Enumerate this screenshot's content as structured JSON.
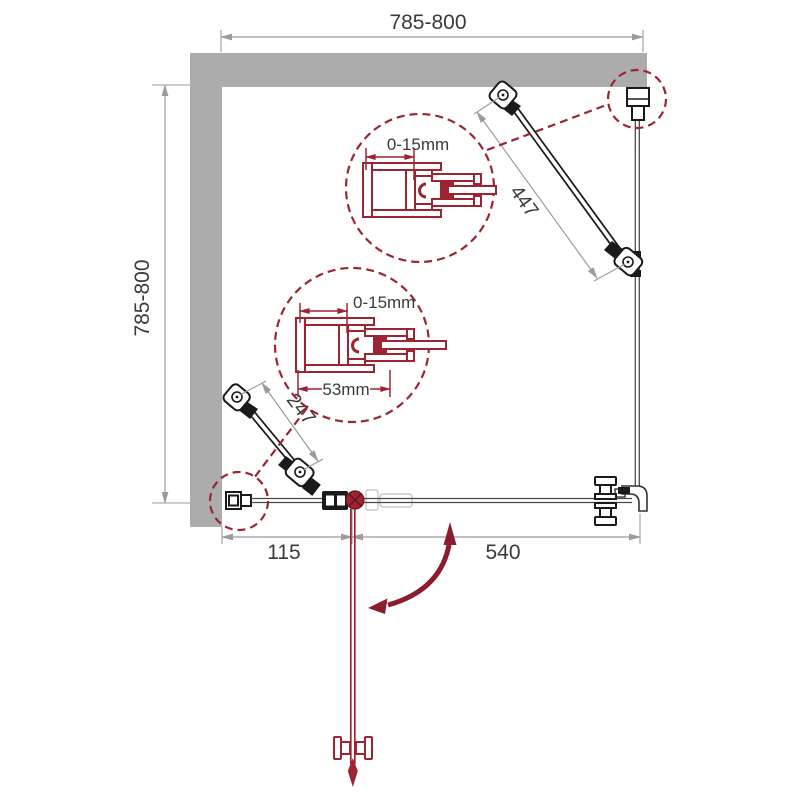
{
  "drawing": {
    "title": "shower-enclosure-plan-view",
    "dimensions": {
      "top_width": "785-800",
      "left_height": "785-800",
      "bottom_fixed_panel": "115",
      "bottom_door": "540",
      "strut_right": "447",
      "strut_left": "247"
    },
    "details": {
      "upper_profile_adjustment": "0-15mm",
      "lower_profile_adjustment": "0-15mm",
      "lower_profile_width": "53mm"
    },
    "colors": {
      "wall": "#ACACAC",
      "profile_red": "#9C2531",
      "arrow_red": "#8C1D2E",
      "dim_line": "#9B9B9B",
      "text": "#3A3A3A",
      "hardware": "#1A1A1A"
    }
  }
}
